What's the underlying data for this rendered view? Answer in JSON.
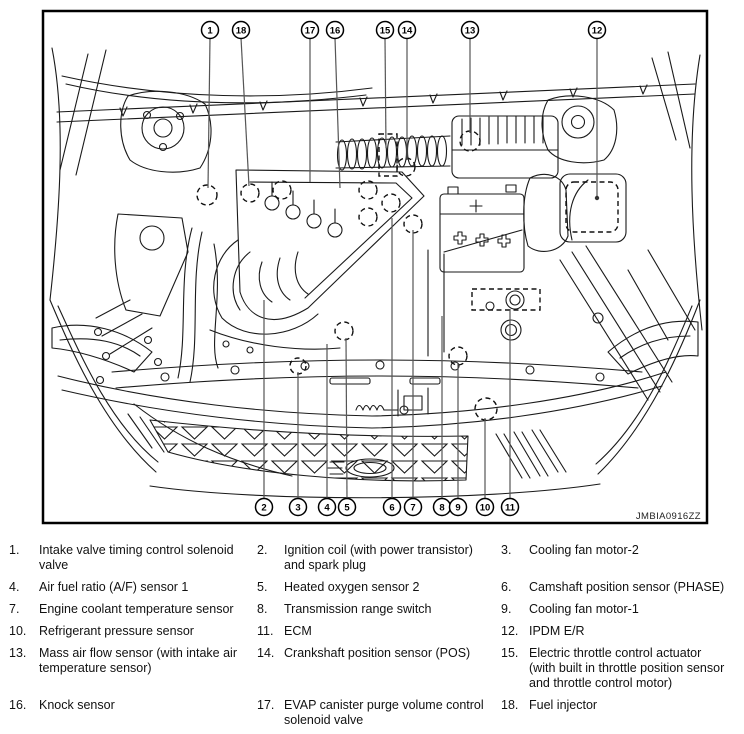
{
  "figure": {
    "frame_label": "JMBIA0916ZZ",
    "callouts_top": [
      {
        "n": "1"
      },
      {
        "n": "18"
      },
      {
        "n": "17"
      },
      {
        "n": "16"
      },
      {
        "n": "15"
      },
      {
        "n": "14"
      },
      {
        "n": "13"
      },
      {
        "n": "12"
      }
    ],
    "callouts_bottom": [
      {
        "n": "2"
      },
      {
        "n": "3"
      },
      {
        "n": "4"
      },
      {
        "n": "5"
      },
      {
        "n": "6"
      },
      {
        "n": "7"
      },
      {
        "n": "8"
      },
      {
        "n": "9"
      },
      {
        "n": "10"
      },
      {
        "n": "11"
      }
    ]
  },
  "legend": {
    "items": [
      {
        "num": "1.",
        "label": "Intake valve timing control solenoid valve"
      },
      {
        "num": "2.",
        "label": "Ignition coil (with power transistor) and spark plug"
      },
      {
        "num": "3.",
        "label": "Cooling fan motor-2"
      },
      {
        "num": "4.",
        "label": "Air fuel ratio (A/F) sensor 1"
      },
      {
        "num": "5.",
        "label": "Heated oxygen sensor 2"
      },
      {
        "num": "6.",
        "label": "Camshaft position sensor (PHASE)"
      },
      {
        "num": "7.",
        "label": "Engine coolant temperature sensor"
      },
      {
        "num": "8.",
        "label": "Transmission range switch"
      },
      {
        "num": "9.",
        "label": "Cooling fan motor-1"
      },
      {
        "num": "10.",
        "label": "Refrigerant pressure sensor"
      },
      {
        "num": "11.",
        "label": "ECM"
      },
      {
        "num": "12.",
        "label": "IPDM E/R"
      },
      {
        "num": "13.",
        "label": "Mass air flow sensor (with intake air temperature sensor)"
      },
      {
        "num": "14.",
        "label": "Crankshaft position sensor (POS)"
      },
      {
        "num": "15.",
        "label": "Electric throttle control actuator (with built in throttle position sensor and throttle control motor)"
      },
      {
        "num": "16.",
        "label": "Knock sensor"
      },
      {
        "num": "17.",
        "label": "EVAP canister purge volume control solenoid valve"
      },
      {
        "num": "18.",
        "label": "Fuel injector"
      }
    ]
  },
  "colors": {
    "line": "#1a1a1a",
    "leader": "#555555",
    "frame": "#000000"
  }
}
